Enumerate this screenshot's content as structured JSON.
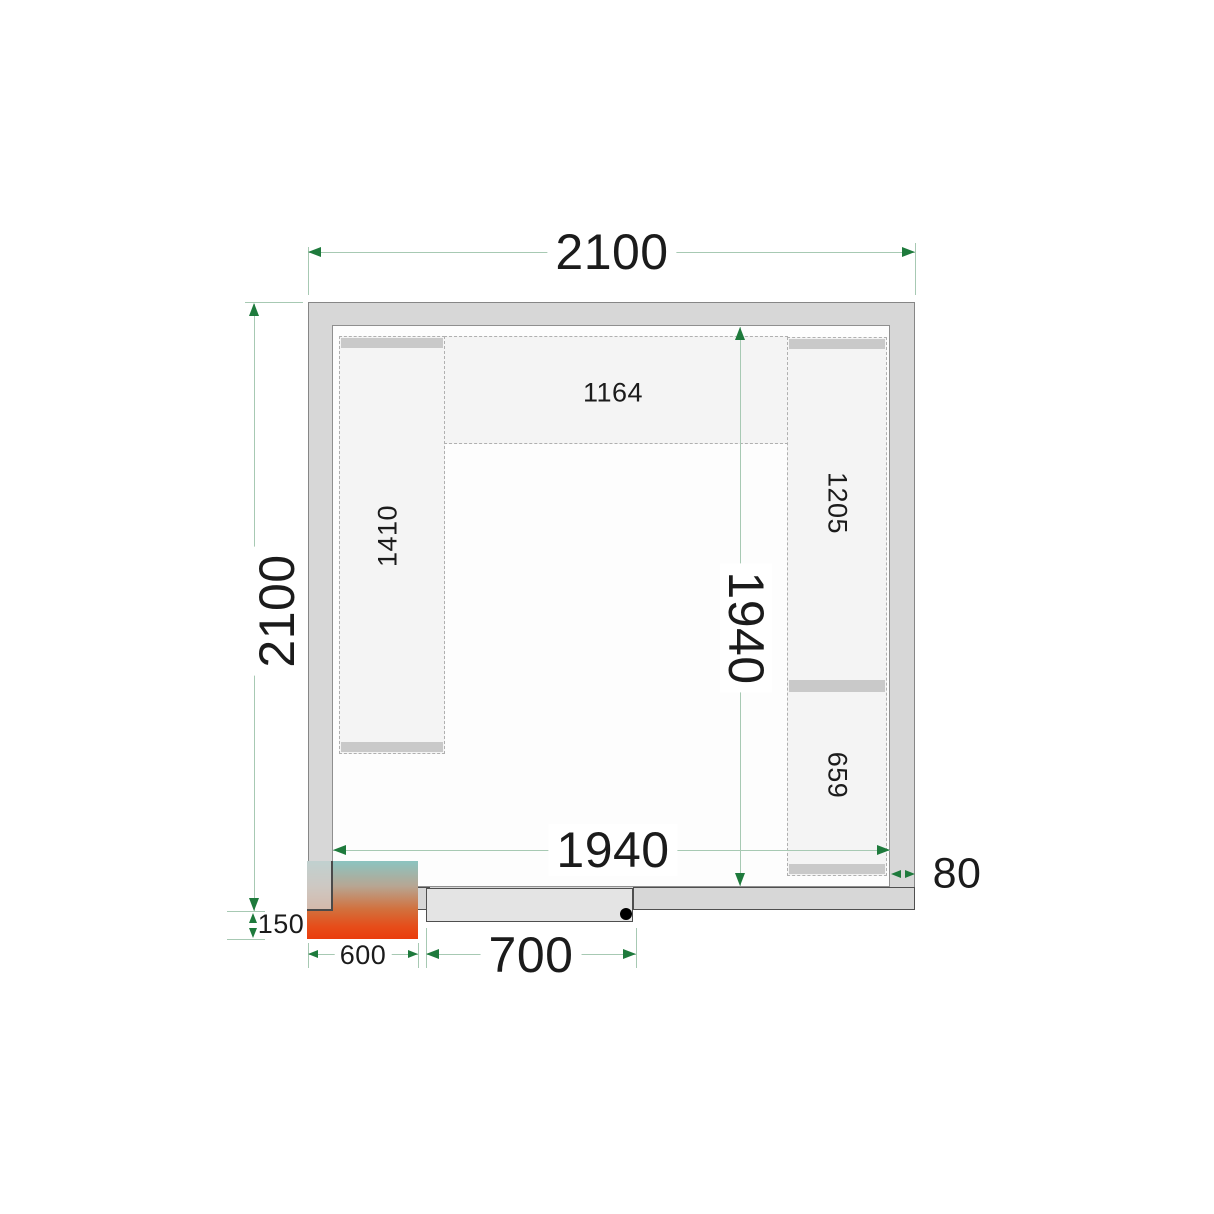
{
  "diagram": {
    "kind": "cold-room floor plan, top view",
    "outer": {
      "width_label": "2100",
      "depth_label": "2100"
    },
    "inner": {
      "width_label": "1940",
      "depth_label": "1940"
    },
    "wall_thickness_label": "80",
    "door": {
      "width_label": "700"
    },
    "cooling_unit": {
      "width_label": "600",
      "protrusion_label": "150"
    },
    "shelving": {
      "top_label": "1164",
      "left_label": "1410",
      "right_upper_label": "1205",
      "right_lower_label": "659"
    },
    "colors": {
      "dimension_line": "#a7c9b3",
      "dimension_arrow": "#1e7a3c",
      "wall_fill": "#d7d7d7",
      "wall_stroke": "#868686",
      "door_stroke": "#4f4f4f",
      "shelf_fill": "#f4f4f4",
      "shelf_band": "#c9c9c9",
      "unit_gradient_top": "#8bc4c0",
      "unit_gradient_bottom": "#ea3c0c"
    }
  }
}
